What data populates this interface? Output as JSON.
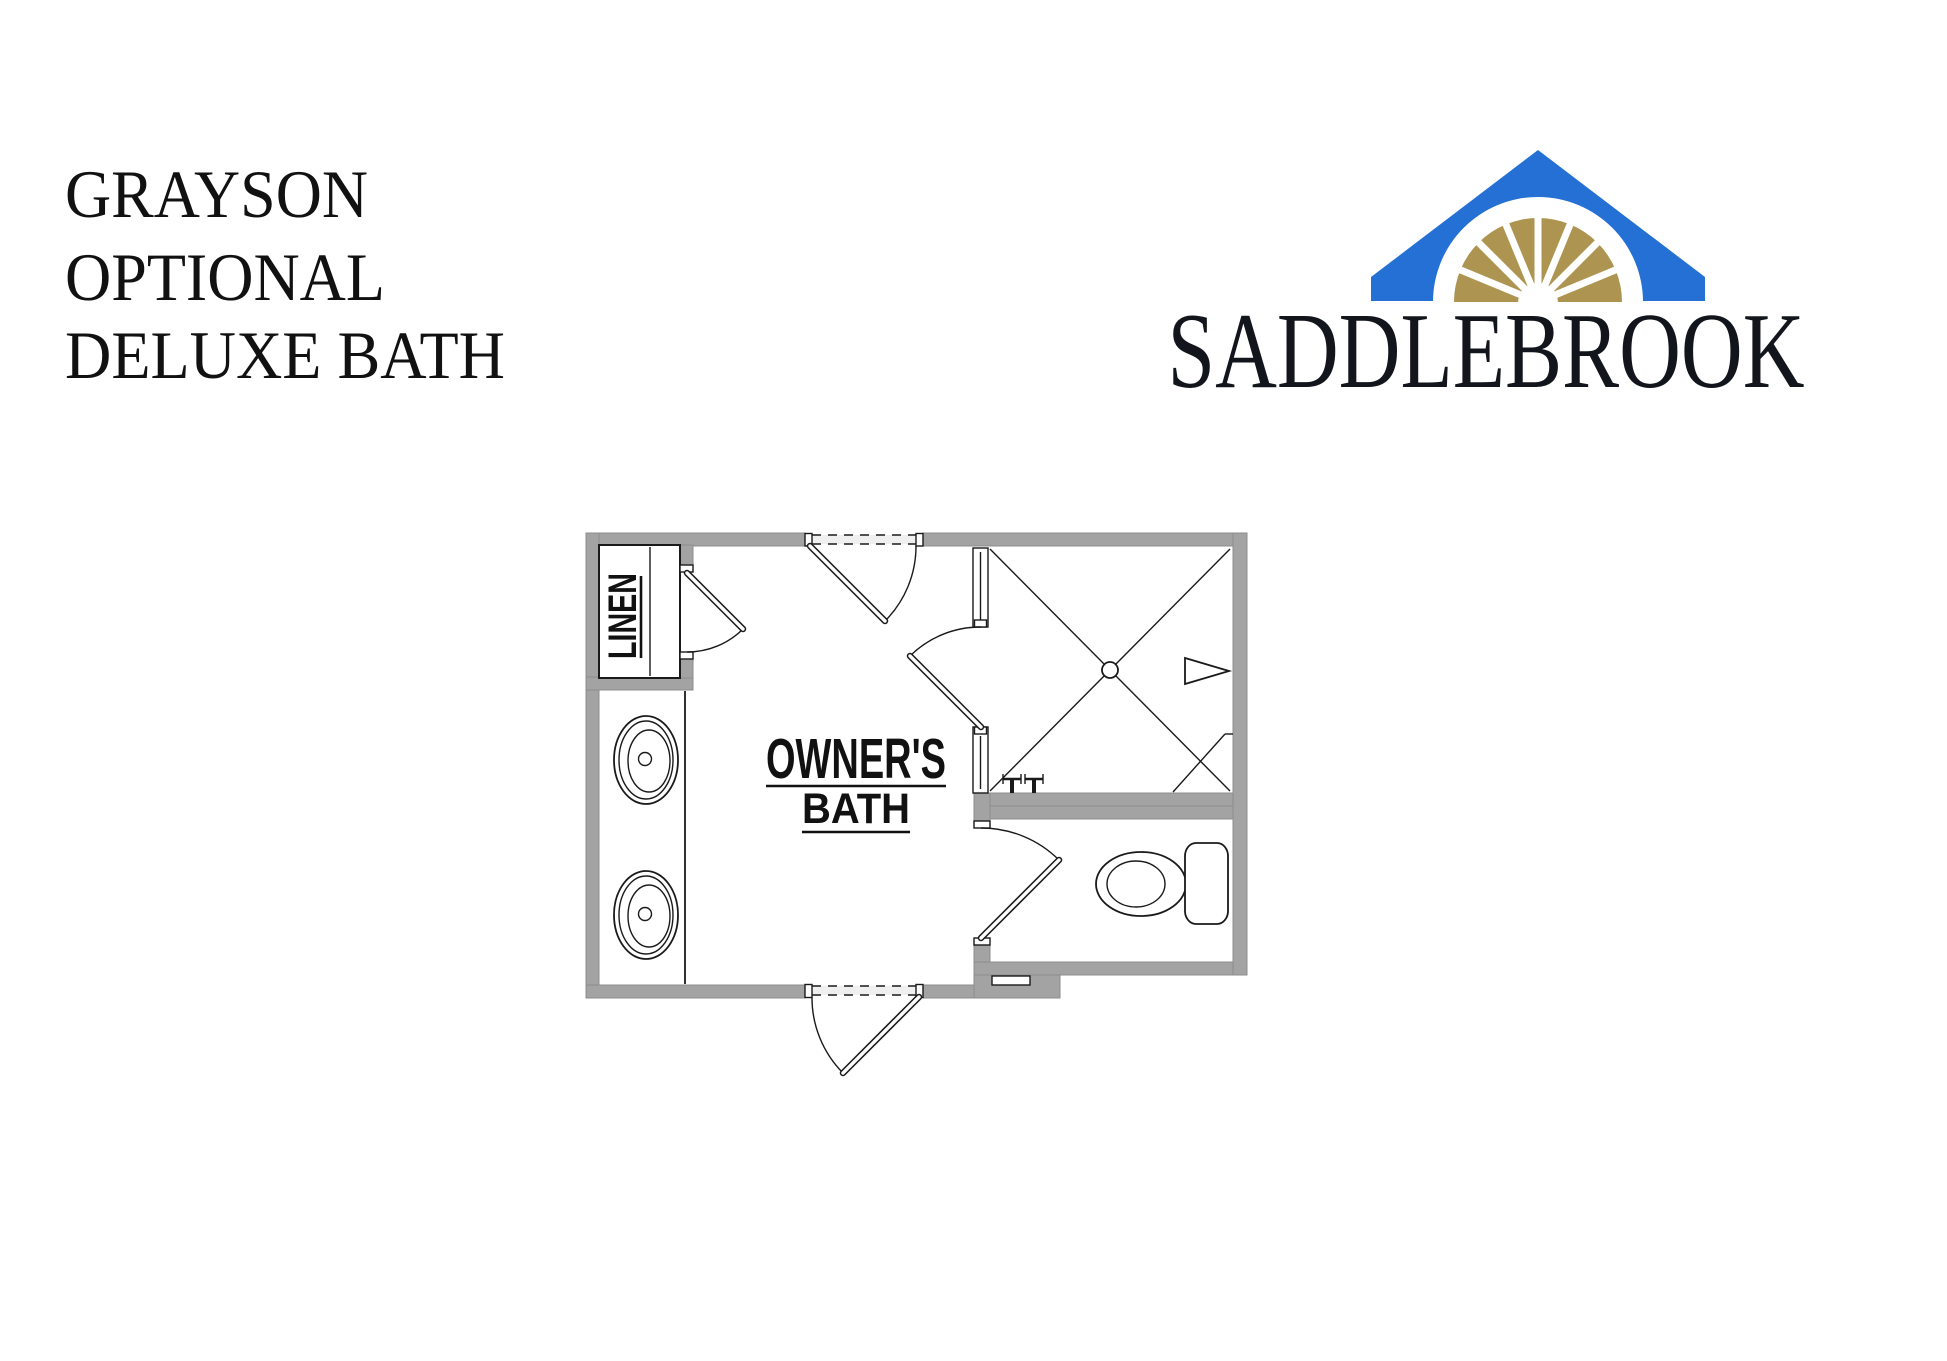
{
  "page": {
    "background": "#ffffff"
  },
  "title_block": {
    "line1": "GRAYSON",
    "line2": "OPTIONAL",
    "line3": "DELUXE BATH"
  },
  "logo": {
    "text": "SADDLEBROOK",
    "colors": {
      "roof_blue": "#2470d4",
      "fan_gold": "#ad9551",
      "text_dark": "#12151b"
    }
  },
  "floor_plan": {
    "labels": {
      "room_line1": "OWNER'S",
      "room_line2": "BATH",
      "closet": "LINEN"
    },
    "colors": {
      "wall_fill": "#a3a3a3",
      "line": "#1a1a1a"
    },
    "fixtures": [
      "linen-closet",
      "vanity-double-sink",
      "shower",
      "toilet"
    ]
  }
}
